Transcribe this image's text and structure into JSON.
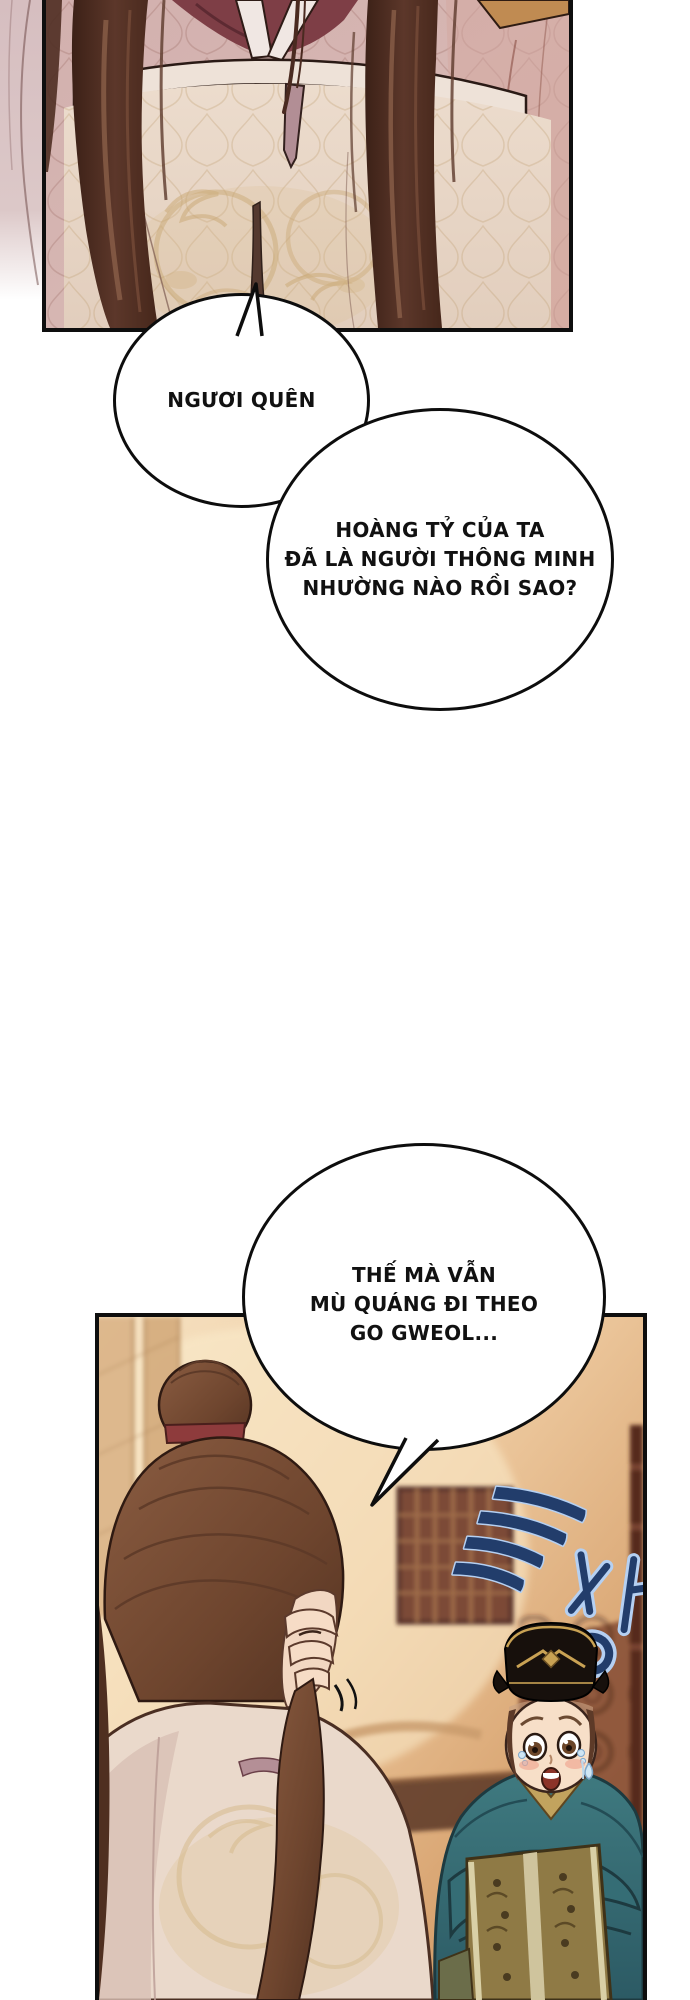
{
  "page": {
    "width": 690,
    "height": 2000,
    "background": "#ffffff",
    "type": "webtoon-comic-page"
  },
  "bubbles": [
    {
      "id": "bubble-1",
      "text": "NGƯƠI QUÊN"
    },
    {
      "id": "bubble-2",
      "lines": [
        "HOÀNG TỶ CỦA TA",
        "ĐÃ LÀ NGƯỜI THÔNG MINH",
        "NHƯỜNG NÀO RỒI SAO?"
      ]
    },
    {
      "id": "bubble-3",
      "lines": [
        "THẾ MÀ VẪN",
        "MÙ QUÁNG ĐI THEO",
        "GO GWEOL..."
      ]
    }
  ],
  "sfx": {
    "text": "글썽!..",
    "fill": "#223d6b",
    "outline": "#b5d0f2"
  },
  "colors": {
    "panel_border": "#0e0e0e",
    "bubble_border": "#0d0d0d",
    "top_panel_fabric_pink": "#d6b6b4",
    "robe_cream": "#ecdccd",
    "embroidery_gold": "#c9a873",
    "collar_maroon": "#7e3e46",
    "hair_dark_brown": "#4a2a1e",
    "bottom_bg_peach": "#f6e2c2",
    "bottom_bg_brown": "#b97f4e",
    "official_robe_teal": "#3f7a80",
    "brocade_gold": "#8f7a45",
    "hat_black": "#17100c",
    "bun_ribbon_red": "#8e3b3c",
    "tear_blue": "#cfe6f4"
  }
}
